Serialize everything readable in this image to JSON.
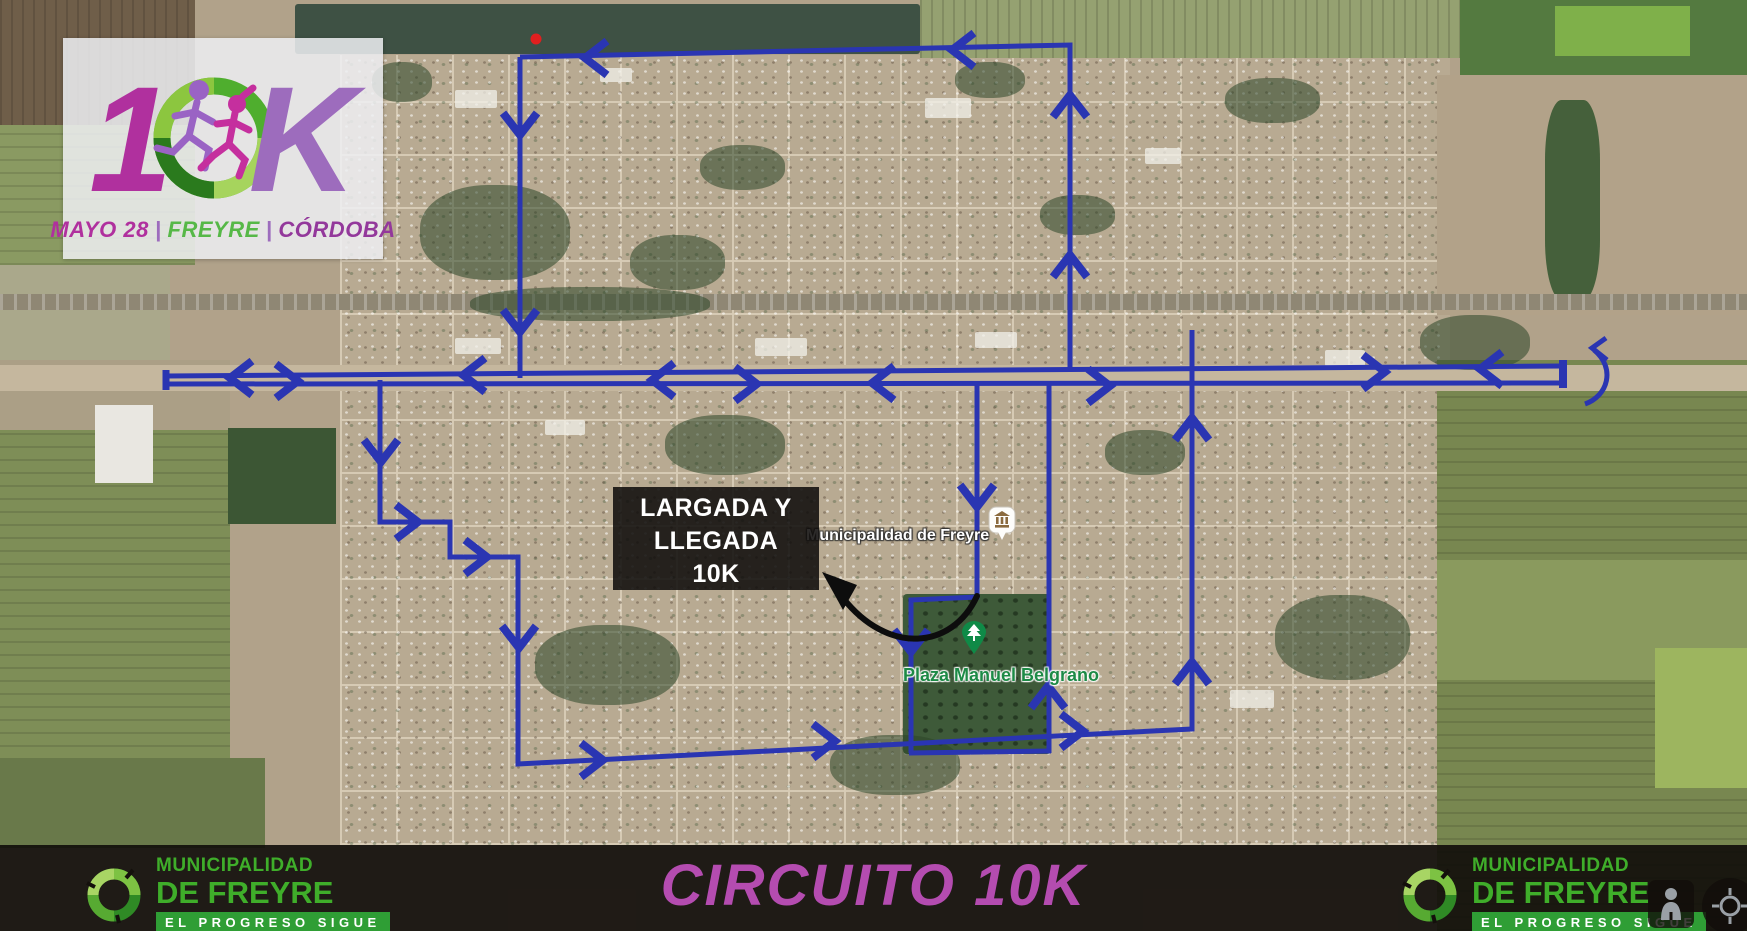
{
  "logo_card": {
    "one": "1",
    "k": "K",
    "date": "MAYO 28",
    "place": "FREYRE",
    "region": "CÓRDOBA",
    "separator": "|"
  },
  "start_finish_box": {
    "line1": "LARGADA Y",
    "line2": "LLEGADA",
    "line3": "10K"
  },
  "map_labels": {
    "municipality": "Municipalidad de Freyre",
    "plaza": "Plaza Manuel Belgrano"
  },
  "footer": {
    "title": "CIRCUITO 10K",
    "logo": {
      "line1": "MUNICIPALIDAD",
      "line2": "DE FREYRE",
      "tagline": "EL PROGRESO SIGUE"
    }
  },
  "colors": {
    "route_blue": "#2a35b2",
    "magenta": "#b0309e",
    "purple": "#9d6cbd",
    "green": "#56b847",
    "footer_green": "#3fae2a",
    "title_magenta": "#b44cb0",
    "arrow_black": "#0d0d0d",
    "marker_red": "#e01f1f",
    "park_green": "#0f8a47"
  }
}
